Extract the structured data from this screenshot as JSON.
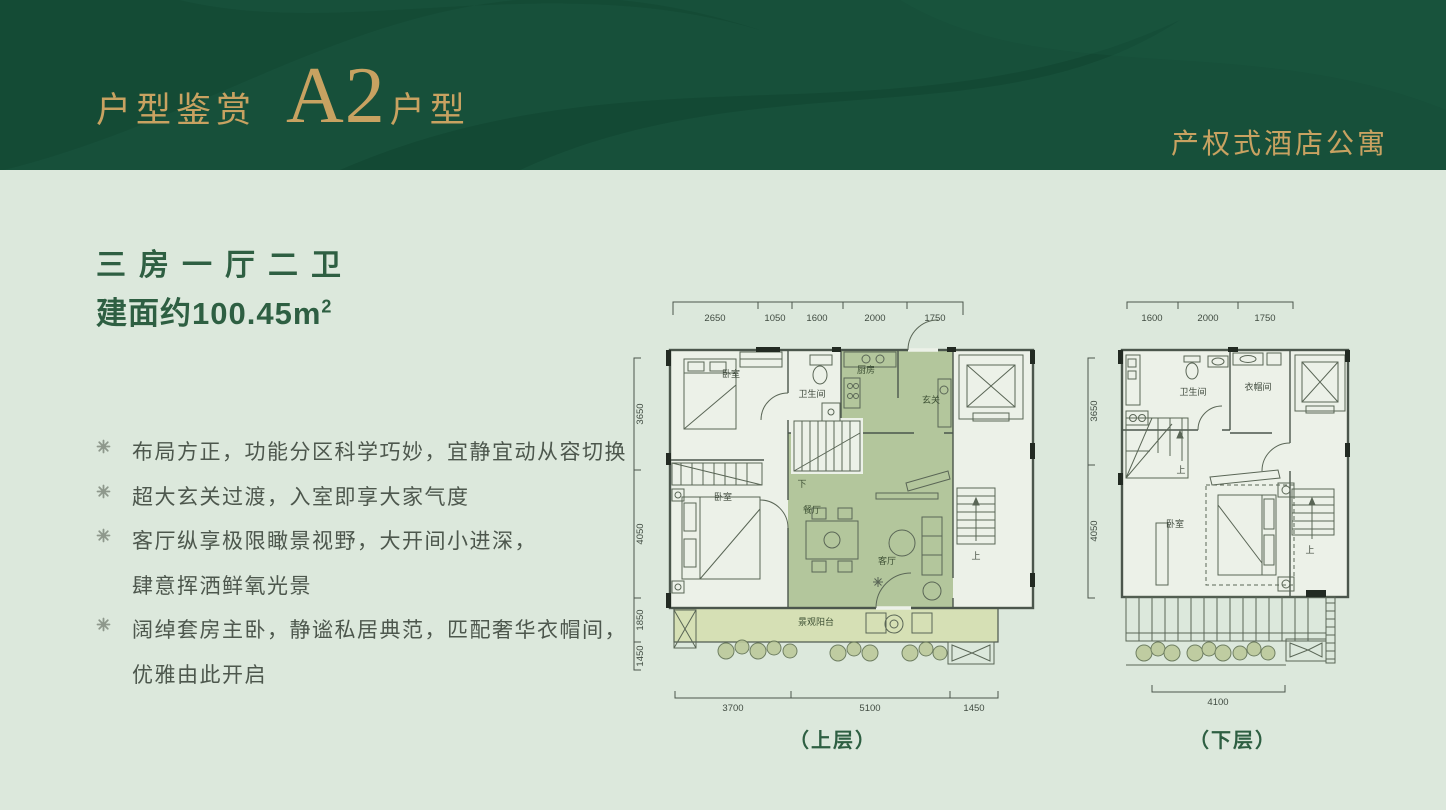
{
  "palette": {
    "header_bg": "#17503a",
    "gold": "#c8a261",
    "page_bg": "#dce8dc",
    "title_green": "#2e5f42",
    "body_text": "#4d574d",
    "plan_line": "#4b564c",
    "highlight_green": "#a9be8e",
    "balcony_green": "#d6e0b5"
  },
  "header": {
    "section_label": "户型鉴赏",
    "unit_code": "A2",
    "unit_suffix": "户型",
    "right_label": "产权式酒店公寓"
  },
  "summary": {
    "layout_title": "三房一厅二卫",
    "area_label": "建面约100.45m",
    "area_sup": "2"
  },
  "features": {
    "bullet_icon": "flower-asterisk-icon",
    "items": [
      {
        "lines": [
          "布局方正，功能分区科学巧妙，宜静宜动从容切换"
        ]
      },
      {
        "lines": [
          "超大玄关过渡，入室即享大家气度"
        ]
      },
      {
        "lines": [
          "客厅纵享极限瞰景视野，大开间小进深，",
          "肆意挥洒鲜氧光景"
        ]
      },
      {
        "lines": [
          "阔绰套房主卧，静谧私居典范，匹配奢华衣帽间，",
          "优雅由此开启"
        ]
      }
    ]
  },
  "upper_plan": {
    "caption": "（上层）",
    "dims_top": [
      "2650",
      "1050",
      "1600",
      "2000",
      "1750"
    ],
    "dims_left": [
      "3650",
      "4050",
      "1850",
      "1450"
    ],
    "dims_bottom": [
      "3700",
      "5100",
      "1450"
    ],
    "rooms": {
      "bedroom1": "卧室",
      "bathroom": "卫生间",
      "kitchen": "厨房",
      "foyer": "玄关",
      "bedroom2": "卧室",
      "dining": "餐厅",
      "living": "客厅",
      "balcony": "景观阳台",
      "stair_down": "下",
      "stair_up": "上"
    }
  },
  "lower_plan": {
    "caption": "（下层）",
    "dims_top": [
      "1600",
      "2000",
      "1750"
    ],
    "dims_left": [
      "3650",
      "4050"
    ],
    "dims_bottom": [
      "4100"
    ],
    "rooms": {
      "bathroom": "卫生间",
      "cloakroom": "衣帽间",
      "bedroom": "卧室",
      "stair_up_left": "上",
      "stair_up_right": "上"
    }
  }
}
